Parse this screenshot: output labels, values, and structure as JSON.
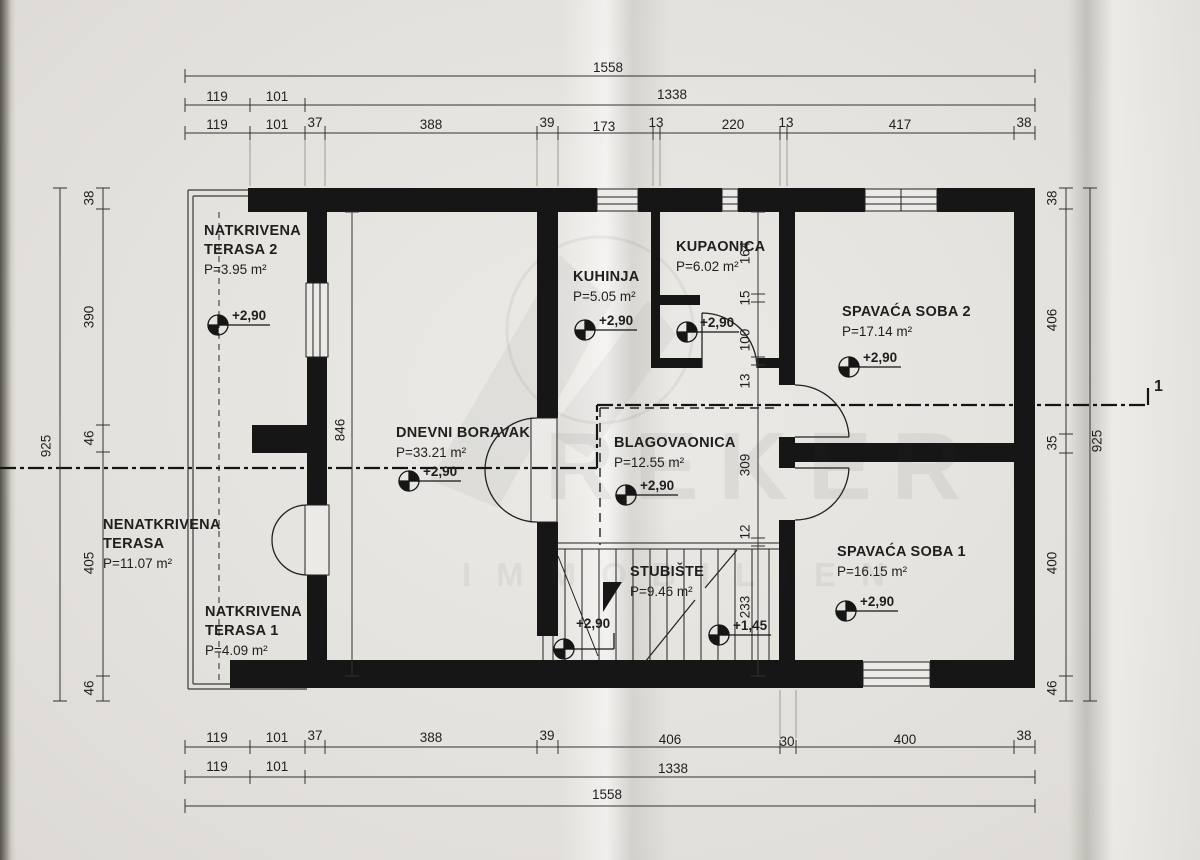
{
  "watermark": {
    "brand": "REKER",
    "sub": "IMMOBILIEN"
  },
  "section_marker": "1",
  "levels": {
    "main": "+2,90",
    "stairs": "+1,45"
  },
  "rooms": [
    {
      "name": "NATKRIVENA",
      "name2": "TERASA 2",
      "area": "P=3.95 m²"
    },
    {
      "name": "KUHINJA",
      "area": "P=5.05 m²"
    },
    {
      "name": "KUPAONICA",
      "area": "P=6.02 m²"
    },
    {
      "name": "SPAVAĆA SOBA 2",
      "area": "P=17.14 m²"
    },
    {
      "name": "DNEVNI BORAVAK",
      "area": "P=33.21 m²"
    },
    {
      "name": "BLAGOVAONICA",
      "area": "P=12.55 m²"
    },
    {
      "name": "NENATKRIVENA",
      "name2": "TERASA",
      "area": "P=11.07 m²"
    },
    {
      "name": "NATKRIVENA",
      "name2": "TERASA 1",
      "area": "P=4.09 m²"
    },
    {
      "name": "STUBIŠTE",
      "area": "P=9.46 m²"
    },
    {
      "name": "SPAVAĆA SOBA 1",
      "area": "P=16.15 m²"
    }
  ],
  "dims": {
    "top": {
      "row1": "1558",
      "row2": [
        "119",
        "101",
        "1338"
      ],
      "row3": [
        "119",
        "101",
        "37",
        "388",
        "39",
        "173",
        "13",
        "220",
        "13",
        "417",
        "38"
      ]
    },
    "bottom": {
      "row1": [
        "119",
        "101",
        "37",
        "388",
        "39",
        "406",
        "30",
        "400",
        "38"
      ],
      "row2": [
        "119",
        "101",
        "1338"
      ],
      "row3": "1558"
    },
    "left": {
      "total": "925",
      "segs": [
        "38",
        "390",
        "46",
        "405",
        "46"
      ]
    },
    "right": {
      "total": "925",
      "segs": [
        "38",
        "406",
        "35",
        "400",
        "46"
      ]
    },
    "inner_left": "846",
    "inner_right": [
      "164",
      "15",
      "100",
      "13",
      "309",
      "12",
      "233"
    ]
  }
}
